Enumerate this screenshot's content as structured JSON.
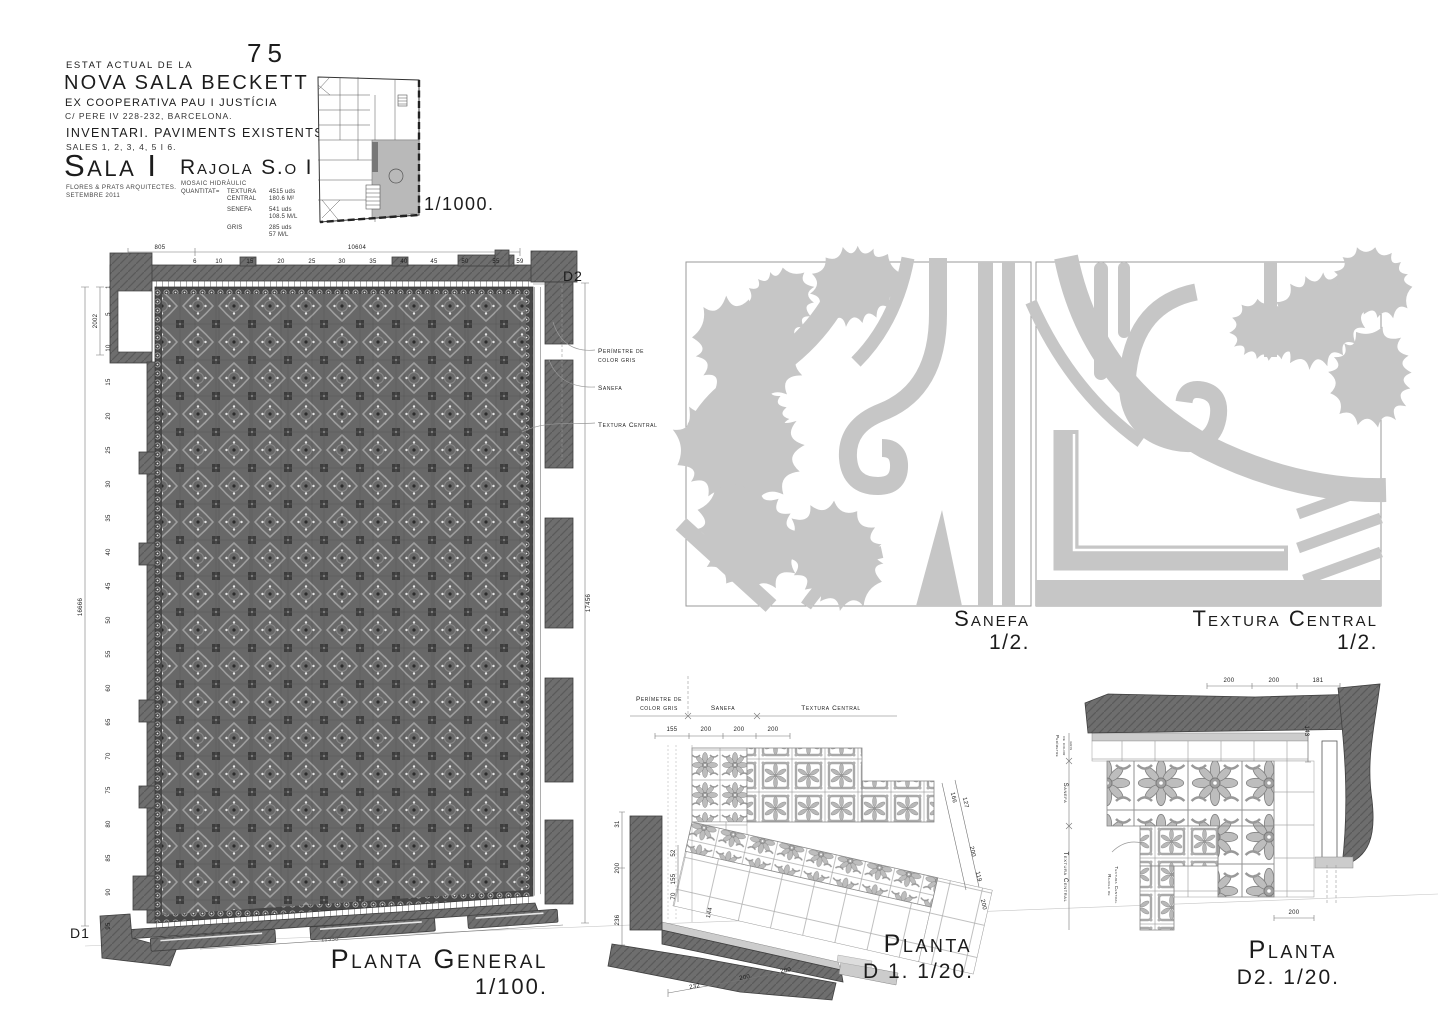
{
  "colors": {
    "wall_gray": "#6e6e6e",
    "detail_gray": "#c6c6c6",
    "paper": "#ffffff",
    "ink": "#1c1c1c"
  },
  "title_block": {
    "sheet_number": "75",
    "pretitle": "ESTAT ACTUAL DE LA",
    "title": "NOVA SALA BECKETT",
    "subtitle1": "EX COOPERATIVA PAU I JUSTÍCIA",
    "subtitle2": "C/ PERE IV 228-232, BARCELONA.",
    "inventory": "INVENTARI. PAVIMENTS EXISTENTS.",
    "sales": "SALES 1, 2, 3, 4, 5 I 6.",
    "room_title": "Sala I",
    "architects": "FLORES & PRATS ARQUITECTES.",
    "date": "SETEMBRE 2011",
    "tile_title": "Rajola S.o I",
    "tile_material": "MOSAIC HIDRÀULIC",
    "qty_label": "QUANTITAT=",
    "quantities": [
      {
        "name": "TEXTURA CENTRAL",
        "qty": "4515 uds",
        "measure": "180.6 M²"
      },
      {
        "name": "SENEFA",
        "qty": "541 uds",
        "measure": "108.5 M/L"
      },
      {
        "name": "GRIS",
        "qty": "285 uds",
        "measure": "57 M/L"
      }
    ],
    "key_plan_scale": "1/1000."
  },
  "planta_general": {
    "label": "Planta General",
    "scale": "1/100.",
    "marker_d2": "D2",
    "marker_d1": "D1",
    "dim_top_minor": "805",
    "dim_top_major": "10604",
    "dim_left_upper": "2002",
    "dim_left_main": "16666",
    "dim_right_main": "17456",
    "dim_bottom": "11338",
    "col_ticks": [
      "6",
      "10",
      "15",
      "20",
      "25",
      "30",
      "35",
      "40",
      "45",
      "50",
      "55",
      "59"
    ],
    "row_ticks": [
      "1",
      "5",
      "10",
      "15",
      "20",
      "25",
      "30",
      "35",
      "40",
      "45",
      "50",
      "55",
      "60",
      "65",
      "70",
      "75",
      "80",
      "85",
      "90",
      "95"
    ],
    "ann_perimetre_1": "Perímetre de",
    "ann_perimetre_2": "color gris",
    "ann_sanefa": "Sanefa",
    "ann_textura": "Textura Central"
  },
  "detail_sanefa": {
    "label": "Sanefa",
    "scale": "1/2."
  },
  "detail_textura": {
    "label": "Textura Central",
    "scale": "1/2."
  },
  "planta_d1": {
    "label": "Planta",
    "scale": "D 1. 1/20.",
    "hdr_perimetre_1": "Perímetre de",
    "hdr_perimetre_2": "color gris",
    "hdr_sanefa": "Sanefa",
    "hdr_textura": "Textura Central",
    "dims_top": [
      "155",
      "200",
      "200",
      "200"
    ],
    "dims_left": [
      "31",
      "200",
      "236"
    ],
    "dims_inner": [
      "52",
      "155",
      "70",
      "144"
    ],
    "dims_right": [
      "166",
      "127",
      "200",
      "119",
      "200"
    ],
    "dims_bottom": [
      "232",
      "200",
      "200"
    ]
  },
  "planta_d2": {
    "label": "Planta",
    "scale": "D2. 1/20.",
    "side_perimetre_1": "Perímetre",
    "side_perimetre_2": "de color",
    "side_perimetre_3": "gris",
    "side_sanefa": "Sanefa",
    "side_textura": "Textura Central",
    "note_rajola_1": "Rajola de",
    "note_rajola_2": "Textura Central",
    "dims_top": [
      "200",
      "200",
      "181"
    ],
    "dim_right": "143",
    "dim_bottom": "200"
  }
}
